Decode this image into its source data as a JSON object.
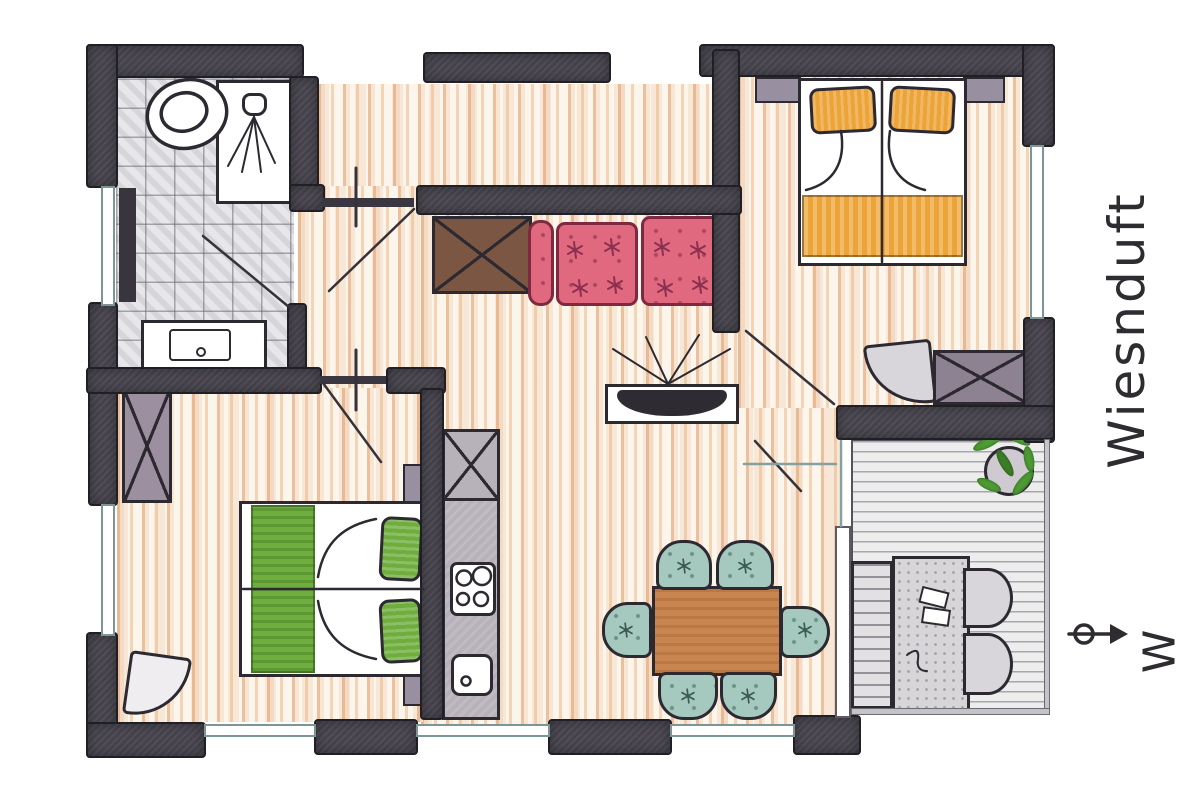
{
  "title": {
    "text": "Wiesnduft"
  },
  "compass": {
    "icon": "north-arrow-icon",
    "direction_letter": "W"
  },
  "colors": {
    "wall": "#46434c",
    "wall_outline": "#211f26",
    "ink": "#2c2931",
    "sofa": "#e0697f",
    "sofa_outline": "#7e2940",
    "bed1_accent": "#eca438",
    "bed2_accent": "#6fae3e",
    "dining_chair": "#a5c8bf",
    "dining_table": "#c9854f",
    "plant": "#4e9a34"
  }
}
